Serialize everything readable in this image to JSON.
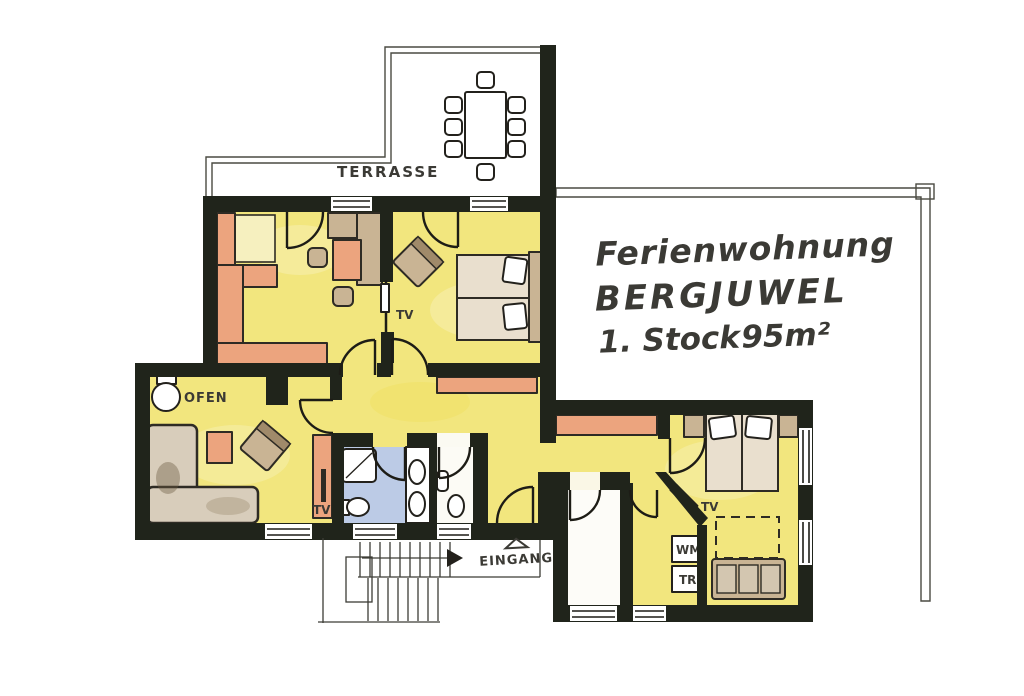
{
  "title": {
    "line1": "Ferienwohnung",
    "line2": "BERGJUWEL",
    "line3": "1. Stock",
    "area": "95m²"
  },
  "labels": {
    "terrace": "TERRASSE",
    "stove": "OFEN",
    "entrance": "EINGANG",
    "washing_machine": "WM",
    "dryer": "TR",
    "tv": "TV"
  },
  "colors": {
    "wall": "#20241b",
    "floor_yellow": "#f2e67e",
    "furniture_salmon": "#eca47e",
    "furniture_tan": "#c9b494",
    "bathroom_blue": "#bccbe6",
    "ink": "#3b3a35",
    "paper": "#ffffff"
  }
}
